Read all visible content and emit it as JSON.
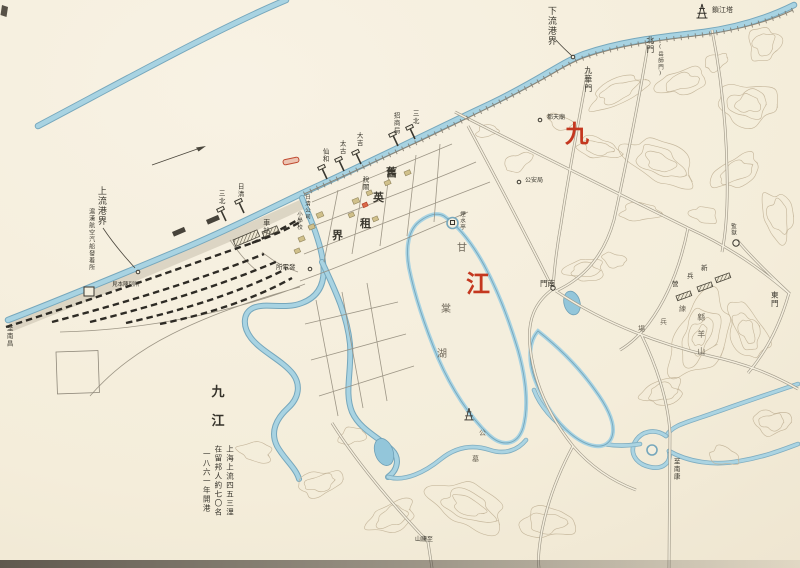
{
  "map": {
    "colors": {
      "paper": "#f4edda",
      "water": "#a8d3e2",
      "red": "#c4371f",
      "ink": "#3b382f",
      "soft": "#6e6759"
    },
    "legend": {
      "title_chars": [
        "九",
        "江"
      ],
      "lines": [
        "上海上流四五三浬",
        "在留邦人約七〇名",
        "一八六一年開港"
      ]
    },
    "labels": [
      {
        "name": "yangtze-char-jiu",
        "text": "九",
        "x": 565,
        "y": 121,
        "mode": "h",
        "size": 24,
        "color": "red",
        "serif": true
      },
      {
        "name": "yangtze-char-jiang",
        "text": "江",
        "x": 466,
        "y": 271,
        "mode": "h",
        "size": 24,
        "color": "red",
        "serif": true
      },
      {
        "name": "lower-port-boundary",
        "text": "下流港界",
        "x": 545,
        "y": 6,
        "mode": "v",
        "size": 9
      },
      {
        "name": "suojiang-pagoda",
        "text": "鎖江塔",
        "x": 712,
        "y": 7,
        "mode": "h",
        "size": 7
      },
      {
        "name": "north-gate",
        "text": "北門",
        "x": 645,
        "y": 36,
        "mode": "v",
        "size": 8
      },
      {
        "name": "north-gate-alt-name",
        "text": "(岳師門)",
        "x": 657,
        "y": 44,
        "mode": "v",
        "size": 5.5
      },
      {
        "name": "jiuhua-gate",
        "text": "九華門",
        "x": 583,
        "y": 66,
        "mode": "v",
        "size": 8
      },
      {
        "name": "dutian-temple",
        "text": "都天廟",
        "x": 547,
        "y": 115,
        "mode": "h",
        "size": 6
      },
      {
        "name": "public-safety-bureau",
        "text": "公安局",
        "x": 525,
        "y": 178,
        "mode": "h",
        "size": 6
      },
      {
        "name": "upper-port-boundary",
        "text": "上流港界",
        "x": 95,
        "y": 186,
        "mode": "v",
        "size": 9
      },
      {
        "name": "steamer-landing",
        "text": "滬漢航空汽船發着所",
        "x": 87,
        "y": 208,
        "mode": "v",
        "size": 6
      },
      {
        "name": "sample-hall",
        "text": "見本陳列所",
        "x": 112,
        "y": 282,
        "mode": "h",
        "size": 5.5
      },
      {
        "name": "to-nanchang",
        "text": "至南昌",
        "x": 5,
        "y": 325,
        "mode": "v",
        "size": 6.5
      },
      {
        "name": "station",
        "text": "車站",
        "x": 262,
        "y": 219,
        "mode": "v",
        "size": 7
      },
      {
        "name": "power-plant",
        "text": "發電所",
        "x": 276,
        "y": 264,
        "mode": "h",
        "size": 6.5,
        "rtl": true
      },
      {
        "name": "pier-sanbei-west",
        "text": "三北",
        "x": 217,
        "y": 190,
        "mode": "v",
        "size": 6.5
      },
      {
        "name": "pier-nisshin",
        "text": "日清",
        "x": 236,
        "y": 183,
        "mode": "v",
        "size": 6.5
      },
      {
        "name": "pier-senwa",
        "text": "仙和",
        "x": 321,
        "y": 148,
        "mode": "v",
        "size": 6.5
      },
      {
        "name": "pier-taiko",
        "text": "太古",
        "x": 338,
        "y": 140,
        "mode": "v",
        "size": 6.5
      },
      {
        "name": "pier-daikichi",
        "text": "大吉",
        "x": 355,
        "y": 132,
        "mode": "v",
        "size": 6.5
      },
      {
        "name": "pier-shoshokyoku",
        "text": "招商局",
        "x": 392,
        "y": 112,
        "mode": "v",
        "size": 6.5
      },
      {
        "name": "pier-sanbei-east",
        "text": "三北",
        "x": 411,
        "y": 110,
        "mode": "v",
        "size": 6.5
      },
      {
        "name": "customs",
        "text": "稅關",
        "x": 361,
        "y": 176,
        "mode": "v",
        "size": 6.5
      },
      {
        "name": "nisshin-company",
        "text": "日清公司",
        "x": 304,
        "y": 194,
        "mode": "v",
        "size": 5.5
      },
      {
        "name": "elementary-school",
        "text": "小學校",
        "x": 296,
        "y": 211,
        "mode": "v",
        "size": 5.5
      },
      {
        "name": "concession-char-1",
        "text": "舊",
        "x": 386,
        "y": 167,
        "mode": "h",
        "size": 11,
        "serif": true
      },
      {
        "name": "concession-char-2",
        "text": "英",
        "x": 373,
        "y": 192,
        "mode": "h",
        "size": 11,
        "serif": true
      },
      {
        "name": "concession-char-3",
        "text": "租",
        "x": 360,
        "y": 218,
        "mode": "h",
        "size": 11,
        "serif": true
      },
      {
        "name": "concession-char-4",
        "text": "界",
        "x": 332,
        "y": 230,
        "mode": "h",
        "size": 11,
        "serif": true
      },
      {
        "name": "yanshui-pavilion",
        "text": "煙水亭",
        "x": 459,
        "y": 211,
        "mode": "v",
        "size": 5.5
      },
      {
        "name": "lake-char-gan",
        "text": "甘",
        "x": 457,
        "y": 243,
        "mode": "h",
        "size": 10,
        "color": "soft"
      },
      {
        "name": "lake-char-tang",
        "text": "棠",
        "x": 441,
        "y": 304,
        "mode": "h",
        "size": 10,
        "color": "soft"
      },
      {
        "name": "lake-char-hu",
        "text": "湖",
        "x": 437,
        "y": 349,
        "mode": "h",
        "size": 10,
        "color": "soft"
      },
      {
        "name": "south-gate",
        "text": "南門",
        "x": 540,
        "y": 280,
        "mode": "h",
        "size": 7.5,
        "rtl": true
      },
      {
        "name": "east-gate",
        "text": "東門",
        "x": 770,
        "y": 291,
        "mode": "v",
        "size": 7.5
      },
      {
        "name": "prison",
        "text": "監獄",
        "x": 730,
        "y": 223,
        "mode": "v",
        "size": 5.5
      },
      {
        "name": "barracks-char-shin",
        "text": "新",
        "x": 701,
        "y": 265,
        "mode": "h",
        "size": 6.5
      },
      {
        "name": "barracks-char-hei",
        "text": "兵",
        "x": 687,
        "y": 273,
        "mode": "h",
        "size": 6.5
      },
      {
        "name": "barracks-char-ei",
        "text": "營",
        "x": 672,
        "y": 281,
        "mode": "h",
        "size": 6.5
      },
      {
        "name": "drill-char-ren",
        "text": "練",
        "x": 679,
        "y": 306,
        "mode": "h",
        "size": 7,
        "color": "soft"
      },
      {
        "name": "drill-char-hei",
        "text": "兵",
        "x": 660,
        "y": 319,
        "mode": "h",
        "size": 7,
        "color": "soft"
      },
      {
        "name": "drill-char-jo",
        "text": "場",
        "x": 638,
        "y": 326,
        "mode": "h",
        "size": 7,
        "color": "soft"
      },
      {
        "name": "mianyang-hill",
        "text": "緜羊山",
        "x": 696,
        "y": 313,
        "mode": "v",
        "size": 8,
        "ls": 9,
        "color": "soft"
      },
      {
        "name": "to-nankang",
        "text": "至南康",
        "x": 672,
        "y": 458,
        "mode": "v",
        "size": 6.5
      },
      {
        "name": "cemetery-char-1",
        "text": "公",
        "x": 479,
        "y": 430,
        "mode": "h",
        "size": 7,
        "color": "soft"
      },
      {
        "name": "cemetery-char-2",
        "text": "墓",
        "x": 472,
        "y": 456,
        "mode": "h",
        "size": 7,
        "color": "soft"
      },
      {
        "name": "to-lushan",
        "text": "至廬山",
        "x": 415,
        "y": 537,
        "mode": "h",
        "size": 6,
        "rtl": true
      }
    ]
  }
}
